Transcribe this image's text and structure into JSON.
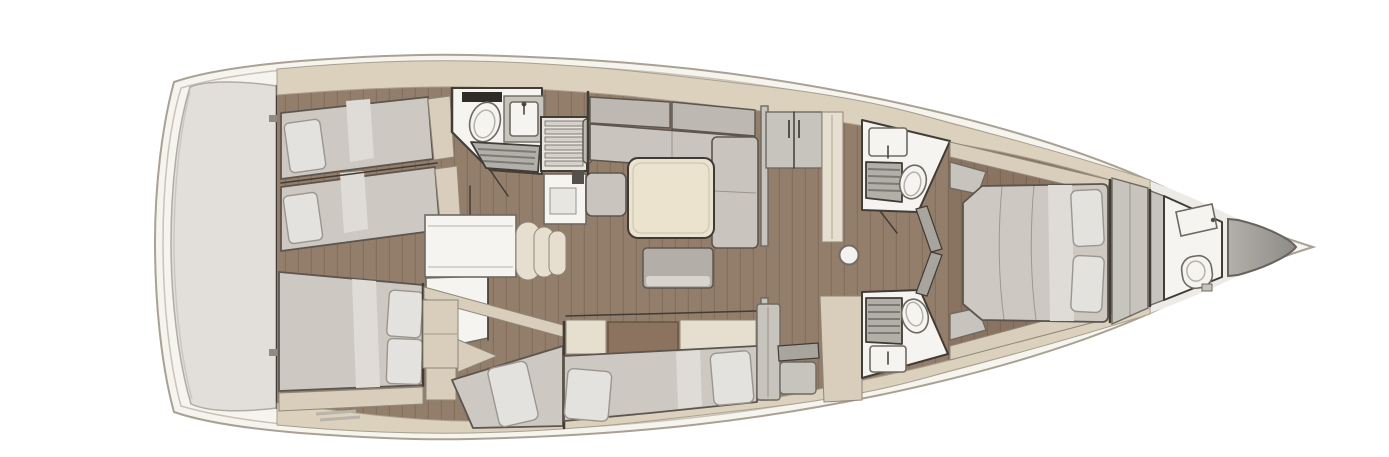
{
  "diagram": {
    "type": "yacht-interior-floor-plan",
    "view": "top-down",
    "orientation": "bow-right-stern-left",
    "visible_text": "",
    "regions": [
      {
        "name": "transom-platform",
        "items": []
      },
      {
        "name": "aft-cabin-port",
        "items": [
          "single-berth",
          "single-berth",
          "pillow",
          "pillow",
          "foot-shelf"
        ]
      },
      {
        "name": "aft-cabin-starboard",
        "items": [
          "double-berth",
          "pillow",
          "pillow",
          "vanity",
          "foot-shelf"
        ]
      },
      {
        "name": "aft-head",
        "items": [
          "toilet",
          "washbasin",
          "shower-grate",
          "door"
        ]
      },
      {
        "name": "companionway",
        "items": [
          "stairs",
          "counter"
        ]
      },
      {
        "name": "chart-desk-area",
        "items": [
          "desk",
          "curved-seat"
        ]
      },
      {
        "name": "salon",
        "items": [
          "l-shaped-sofa",
          "square-table",
          "ottoman",
          "side-seat",
          "bulkhead"
        ]
      },
      {
        "name": "mid-cabin-port",
        "items": [
          "berth",
          "pillow",
          "cabinet-stack",
          "counter"
        ]
      },
      {
        "name": "mid-cabin-center",
        "items": [
          "double-berth",
          "pillow",
          "pillow",
          "sideboard",
          "tall-cabinet"
        ]
      },
      {
        "name": "nav-station",
        "items": [
          "desk-shelf",
          "seat",
          "side-panel"
        ]
      },
      {
        "name": "corridor",
        "items": [
          "wardrobe-lockers",
          "tall-cabinet",
          "mast-post"
        ]
      },
      {
        "name": "forward-head-port",
        "items": [
          "washbasin",
          "shower-grate",
          "toilet",
          "door"
        ]
      },
      {
        "name": "forward-head-starboard",
        "items": [
          "shower-grate",
          "toilet",
          "washbasin"
        ]
      },
      {
        "name": "owner-cabin",
        "items": [
          "island-double-bed",
          "pillow",
          "pillow",
          "corner-seat",
          "corner-seat",
          "shelf",
          "wardrobe-bulkhead"
        ]
      },
      {
        "name": "bow-head",
        "items": [
          "washbasin",
          "toilet"
        ]
      },
      {
        "name": "bow",
        "items": [
          "sail-locker"
        ]
      }
    ]
  },
  "palette": {
    "hull": "#f6f4ef",
    "hullLine": "#a9a193",
    "hullLine2": "#c9c2b6",
    "transom": "#e2dfdb",
    "deck": "#dbd1bd",
    "deckEdge": "#a89f8e",
    "wood": "#937d6b",
    "wall": "#413c36",
    "white": "#f5f4f1",
    "room": "#edebe7",
    "mattress": "#cdc9c2",
    "mattressLine": "#5c564f",
    "pillow": "#e4e2de",
    "pillowLine": "#9a958e",
    "blanket": "#dfdcd7",
    "tan": "#d8cebb",
    "tanLine": "#8f8778",
    "brown": "#8c7360",
    "cream": "#e6dfd0",
    "sofa": "#c9c5be",
    "sofaBack": "#bdb9b2",
    "table": "#ece3cf",
    "ottoman": "#b3afa8",
    "ottomanFront": "#d7d4ce",
    "grate": "#b2afa9",
    "grateLine": "#7d7a74",
    "gray": "#c7c3bd",
    "grayDark": "#a8a49e",
    "locker1": "#aba8a2",
    "locker2": "#8e8b86",
    "fixtureLine": "#6e6963"
  }
}
